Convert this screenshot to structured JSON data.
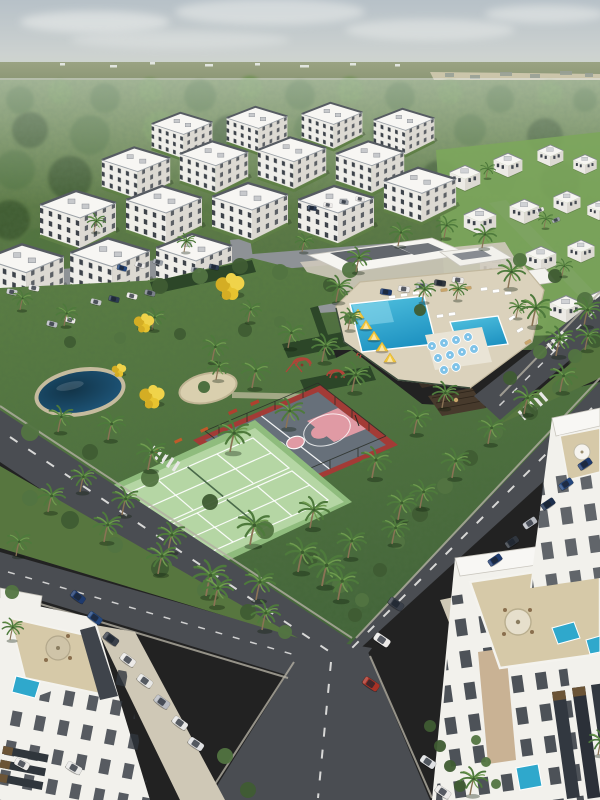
{
  "meta": {
    "alt_text": "Aerial rendering of a tropical residential community: white apartment blocks by a forest, central park with basketball and tennis courts, pond, playground, clubhouse with swimming pools, palm-lined roads and parked cars"
  },
  "palette": {
    "sky_top": "#b7c1c8",
    "sky_bottom": "#d7dad4",
    "forest_dark": "#3f5c33",
    "forest_mid": "#527441",
    "forest_light": "#6d9150",
    "park_green": "#5d8045",
    "road_asphalt": "#4a4d52",
    "pool_blue": "#2fa8cc",
    "court_pink": "#e09aa4",
    "court_red": "#a33b36",
    "tennis_green": "#b5d6a4",
    "cabana_yellow": "#f2c73c",
    "building_white": "#f2f1ec",
    "terrace_tan": "#d6c9a8",
    "pond_blue": "#1f5a80"
  },
  "scene": {
    "clouds": [
      [
        95,
        22,
        75,
        11,
        0.55
      ],
      [
        270,
        12,
        95,
        13,
        0.5
      ],
      [
        430,
        30,
        85,
        11,
        0.45
      ],
      [
        545,
        14,
        60,
        9,
        0.5
      ],
      [
        180,
        40,
        110,
        9,
        0.35
      ]
    ],
    "specks": [
      [
        60,
        63,
        5,
        0
      ],
      [
        110,
        65,
        7,
        0
      ],
      [
        150,
        62,
        5,
        0
      ],
      [
        205,
        64,
        8,
        0
      ],
      [
        255,
        63,
        5,
        0
      ],
      [
        300,
        65,
        9,
        0
      ],
      [
        350,
        63,
        6,
        0
      ],
      [
        395,
        64,
        5,
        0
      ],
      [
        445,
        73,
        9,
        1
      ],
      [
        470,
        75,
        10,
        1
      ],
      [
        500,
        72,
        12,
        1
      ],
      [
        530,
        74,
        10,
        1
      ],
      [
        560,
        71,
        12,
        1
      ],
      [
        585,
        73,
        8,
        1
      ]
    ],
    "forest_blobs": [
      [
        20,
        100,
        14,
        1
      ],
      [
        60,
        92,
        12,
        2
      ],
      [
        105,
        98,
        15,
        1
      ],
      [
        150,
        90,
        12,
        2
      ],
      [
        200,
        96,
        16,
        1
      ],
      [
        250,
        88,
        12,
        2
      ],
      [
        300,
        95,
        15,
        1
      ],
      [
        350,
        90,
        13,
        2
      ],
      [
        400,
        97,
        15,
        1
      ],
      [
        450,
        92,
        12,
        2
      ],
      [
        500,
        99,
        14,
        1
      ],
      [
        550,
        93,
        12,
        2
      ],
      [
        585,
        100,
        12,
        1
      ],
      [
        30,
        130,
        18,
        0
      ],
      [
        90,
        135,
        20,
        1
      ],
      [
        160,
        128,
        17,
        2
      ],
      [
        230,
        134,
        19,
        0
      ],
      [
        310,
        128,
        16,
        1
      ],
      [
        390,
        133,
        18,
        0
      ],
      [
        470,
        130,
        16,
        1
      ],
      [
        545,
        136,
        18,
        0
      ],
      [
        15,
        170,
        20,
        1
      ],
      [
        70,
        178,
        22,
        0
      ],
      [
        130,
        172,
        18,
        1
      ],
      [
        440,
        180,
        20,
        0
      ],
      [
        500,
        176,
        18,
        1
      ],
      [
        560,
        182,
        20,
        0
      ],
      [
        10,
        220,
        20,
        0
      ],
      [
        40,
        250,
        22,
        1
      ],
      [
        15,
        290,
        20,
        0
      ],
      [
        30,
        330,
        22,
        1
      ],
      [
        10,
        370,
        20,
        0
      ],
      [
        25,
        400,
        18,
        1
      ],
      [
        560,
        330,
        16,
        0
      ],
      [
        585,
        360,
        15,
        1
      ],
      [
        470,
        350,
        14,
        0
      ],
      [
        430,
        330,
        12,
        1
      ]
    ],
    "bushes": [
      [
        30,
        498,
        8,
        1
      ],
      [
        70,
        520,
        9,
        0
      ],
      [
        115,
        545,
        8,
        1
      ],
      [
        160,
        568,
        9,
        0
      ],
      [
        205,
        590,
        8,
        1
      ],
      [
        248,
        612,
        8,
        0
      ],
      [
        285,
        632,
        7,
        1
      ],
      [
        30,
        432,
        9,
        1
      ],
      [
        90,
        452,
        8,
        0
      ],
      [
        150,
        478,
        9,
        1
      ],
      [
        210,
        502,
        8,
        0
      ],
      [
        265,
        530,
        9,
        1
      ],
      [
        310,
        558,
        8,
        0
      ],
      [
        340,
        585,
        8,
        1
      ],
      [
        355,
        615,
        7,
        0
      ],
      [
        560,
        388,
        8,
        1
      ],
      [
        530,
        412,
        8,
        0
      ],
      [
        575,
        356,
        7,
        1
      ],
      [
        495,
        432,
        8,
        1
      ],
      [
        470,
        458,
        8,
        0
      ],
      [
        445,
        486,
        8,
        1
      ],
      [
        420,
        514,
        8,
        0
      ],
      [
        398,
        542,
        7,
        1
      ],
      [
        380,
        570,
        7,
        0
      ],
      [
        362,
        600,
        7,
        1
      ],
      [
        12,
        592,
        7,
        1
      ],
      [
        225,
        756,
        8,
        1
      ],
      [
        248,
        790,
        8,
        0
      ],
      [
        430,
        726,
        6,
        0
      ],
      [
        440,
        746,
        6,
        0
      ],
      [
        450,
        766,
        6,
        0
      ],
      [
        460,
        786,
        6,
        0
      ],
      [
        476,
        740,
        5,
        1
      ],
      [
        486,
        762,
        5,
        1
      ],
      [
        496,
        784,
        5,
        1
      ],
      [
        350,
        270,
        8,
        1
      ],
      [
        330,
        285,
        7,
        0
      ],
      [
        520,
        260,
        7,
        1
      ],
      [
        555,
        276,
        7,
        0
      ],
      [
        585,
        300,
        8,
        1
      ],
      [
        595,
        340,
        8,
        0
      ],
      [
        540,
        352,
        7,
        1
      ],
      [
        510,
        378,
        7,
        0
      ],
      [
        160,
        286,
        8,
        0
      ],
      [
        200,
        276,
        8,
        1
      ],
      [
        240,
        266,
        8,
        0
      ],
      [
        280,
        272,
        8,
        1
      ],
      [
        245,
        330,
        7,
        0
      ],
      [
        280,
        322,
        6,
        1
      ],
      [
        70,
        342,
        6,
        0
      ],
      [
        120,
        338,
        6,
        1
      ],
      [
        180,
        334,
        6,
        0
      ],
      [
        350,
        318,
        6,
        1
      ],
      [
        420,
        310,
        6,
        0
      ]
    ],
    "apt_blocks": [
      [
        150,
        108,
        0.8
      ],
      [
        225,
        102,
        0.8
      ],
      [
        300,
        98,
        0.8
      ],
      [
        372,
        104,
        0.8
      ],
      [
        100,
        142,
        0.9
      ],
      [
        178,
        136,
        0.9
      ],
      [
        256,
        132,
        0.9
      ],
      [
        334,
        136,
        0.9
      ],
      [
        38,
        185,
        1.0
      ],
      [
        124,
        180,
        1.0
      ],
      [
        210,
        177,
        1.0
      ],
      [
        296,
        180,
        1.0
      ],
      [
        382,
        162,
        0.95
      ],
      [
        -18,
        238,
        1.05
      ],
      [
        68,
        232,
        1.05
      ],
      [
        154,
        228,
        1.0
      ]
    ],
    "villas": [
      [
        448,
        162,
        0.85
      ],
      [
        492,
        150,
        0.8
      ],
      [
        536,
        142,
        0.72
      ],
      [
        572,
        152,
        0.65
      ],
      [
        462,
        204,
        0.9
      ],
      [
        508,
        196,
        0.82
      ],
      [
        552,
        188,
        0.75
      ],
      [
        586,
        198,
        0.65
      ],
      [
        478,
        250,
        0.95
      ],
      [
        524,
        243,
        0.85
      ],
      [
        566,
        237,
        0.75
      ],
      [
        500,
        298,
        1.0
      ],
      [
        548,
        292,
        0.9
      ],
      [
        588,
        286,
        0.8
      ]
    ],
    "palms": [
      [
        212,
        362,
        0.85
      ],
      [
        252,
        388,
        0.95
      ],
      [
        288,
        348,
        0.85
      ],
      [
        322,
        362,
        0.9
      ],
      [
        352,
        392,
        0.95
      ],
      [
        230,
        452,
        1.05
      ],
      [
        286,
        428,
        0.95
      ],
      [
        148,
        470,
        1.0
      ],
      [
        108,
        440,
        0.9
      ],
      [
        58,
        432,
        0.85
      ],
      [
        372,
        478,
        1.0
      ],
      [
        398,
        520,
        0.95
      ],
      [
        338,
        600,
        1.05
      ],
      [
        298,
        572,
        1.1
      ],
      [
        256,
        600,
        1.0
      ],
      [
        250,
        545,
        1.1
      ],
      [
        310,
        528,
        1.0
      ],
      [
        216,
        380,
        0.75
      ],
      [
        414,
        434,
        0.9
      ],
      [
        442,
        408,
        0.85
      ],
      [
        48,
        512,
        0.9
      ],
      [
        104,
        542,
        0.95
      ],
      [
        158,
        574,
        1.0
      ],
      [
        214,
        606,
        1.0
      ],
      [
        262,
        630,
        0.95
      ],
      [
        560,
        392,
        0.9
      ],
      [
        524,
        414,
        0.9
      ],
      [
        585,
        350,
        0.8
      ],
      [
        488,
        444,
        0.9
      ],
      [
        452,
        478,
        0.95
      ],
      [
        420,
        508,
        0.9
      ],
      [
        392,
        544,
        0.9
      ],
      [
        336,
        302,
        0.85
      ],
      [
        356,
        272,
        0.8
      ],
      [
        398,
        246,
        0.75
      ],
      [
        444,
        238,
        0.7
      ],
      [
        482,
        248,
        0.75
      ],
      [
        508,
        288,
        0.9
      ],
      [
        532,
        326,
        1.0
      ],
      [
        556,
        356,
        0.95
      ],
      [
        584,
        326,
        0.9
      ],
      [
        206,
        596,
        1.15
      ],
      [
        16,
        556,
        0.8
      ],
      [
        10,
        640,
        0.7
      ],
      [
        322,
        586,
        1.15
      ],
      [
        348,
        558,
        0.95
      ],
      [
        470,
        795,
        0.9
      ],
      [
        598,
        755,
        0.8
      ],
      [
        64,
        326,
        0.7
      ],
      [
        152,
        330,
        0.7
      ],
      [
        248,
        322,
        0.7
      ],
      [
        348,
        330,
        0.7
      ],
      [
        422,
        302,
        0.7
      ],
      [
        302,
        252,
        0.6
      ],
      [
        184,
        252,
        0.6
      ],
      [
        94,
        232,
        0.6
      ],
      [
        20,
        310,
        0.65
      ],
      [
        456,
        300,
        0.6
      ],
      [
        516,
        318,
        0.6
      ],
      [
        562,
        276,
        0.55
      ],
      [
        486,
        178,
        0.5
      ],
      [
        544,
        228,
        0.5
      ],
      [
        168,
        552,
        0.95
      ],
      [
        122,
        515,
        0.9
      ],
      [
        80,
        492,
        0.85
      ]
    ],
    "yellow_trees": [
      [
        230,
        288,
        1.2
      ],
      [
        144,
        324,
        0.85
      ],
      [
        152,
        398,
        1.05
      ],
      [
        119,
        371,
        0.6
      ]
    ],
    "cars": [
      [
        78,
        597,
        36,
        0.85,
        "#1e3a6e"
      ],
      [
        95,
        618,
        36,
        0.85,
        "#24477e"
      ],
      [
        111,
        639,
        36,
        0.9,
        "#3a404a"
      ],
      [
        128,
        660,
        36,
        0.9,
        "#eceae8"
      ],
      [
        145,
        681,
        36,
        0.9,
        "#e8e8e6"
      ],
      [
        162,
        702,
        36,
        0.9,
        "#b9bcc2"
      ],
      [
        180,
        723,
        36,
        0.9,
        "#e8e8e6"
      ],
      [
        196,
        744,
        34,
        0.9,
        "#dfe0e2"
      ],
      [
        74,
        768,
        30,
        0.9,
        "#e8e8e6"
      ],
      [
        22,
        764,
        28,
        0.85,
        "#eceae8"
      ],
      [
        396,
        604,
        34,
        0.9,
        "#3a404a"
      ],
      [
        382,
        640,
        34,
        0.95,
        "#eceae8"
      ],
      [
        371,
        684,
        34,
        0.95,
        "#a83226"
      ],
      [
        428,
        762,
        34,
        0.9,
        "#dfe0e2"
      ],
      [
        443,
        792,
        34,
        0.9,
        "#eceae8"
      ],
      [
        585,
        464,
        -34,
        0.8,
        "#1e3a6e"
      ],
      [
        566,
        484,
        -34,
        0.8,
        "#24477e"
      ],
      [
        548,
        504,
        -34,
        0.8,
        "#1c2f4e"
      ],
      [
        530,
        523,
        -34,
        0.8,
        "#b9bcc2"
      ],
      [
        512,
        542,
        -34,
        0.8,
        "#30363e"
      ],
      [
        495,
        560,
        -34,
        0.8,
        "#1e3a6e"
      ],
      [
        96,
        302,
        14,
        0.6,
        "#c8cacd"
      ],
      [
        114,
        299,
        14,
        0.6,
        "#2c3b52"
      ],
      [
        132,
        296,
        14,
        0.6,
        "#eceae8"
      ],
      [
        150,
        293,
        14,
        0.6,
        "#7a8089"
      ],
      [
        122,
        268,
        16,
        0.55,
        "#24477e"
      ],
      [
        140,
        265,
        16,
        0.55,
        "#eceae8"
      ],
      [
        158,
        262,
        16,
        0.55,
        "#9aa0a8"
      ],
      [
        312,
        208,
        10,
        0.5,
        "#2c3b52"
      ],
      [
        328,
        205,
        10,
        0.5,
        "#eceae8"
      ],
      [
        344,
        202,
        10,
        0.5,
        "#9aa0a8"
      ],
      [
        360,
        199,
        10,
        0.5,
        "#eceae8"
      ],
      [
        386,
        292,
        8,
        0.65,
        "#1e3a6e"
      ],
      [
        404,
        289,
        8,
        0.65,
        "#eceae8"
      ],
      [
        422,
        286,
        8,
        0.65,
        "#b9bcc2"
      ],
      [
        440,
        283,
        8,
        0.65,
        "#30363e"
      ],
      [
        458,
        280,
        8,
        0.65,
        "#eceae8"
      ],
      [
        12,
        292,
        12,
        0.6,
        "#c8cacd"
      ],
      [
        34,
        288,
        12,
        0.6,
        "#eceae8"
      ],
      [
        52,
        324,
        14,
        0.6,
        "#b9bcc2"
      ],
      [
        70,
        320,
        14,
        0.6,
        "#eceae8"
      ],
      [
        196,
        270,
        12,
        0.55,
        "#9aa0a8"
      ],
      [
        214,
        267,
        12,
        0.55,
        "#2c3b52"
      ],
      [
        540,
        210,
        -20,
        0.45,
        "#eceae8"
      ],
      [
        556,
        220,
        -20,
        0.45,
        "#9aa0a8"
      ]
    ],
    "loungers": [
      [
        392,
        297,
        -7,
        "#ffffff"
      ],
      [
        404,
        295,
        -7,
        "#ffffff"
      ],
      [
        416,
        293,
        -7,
        "#ffffff"
      ],
      [
        428,
        292,
        -7,
        "#ffffff"
      ],
      [
        444,
        290,
        -7,
        "#c9a56a"
      ],
      [
        456,
        289,
        -7,
        "#c9a56a"
      ],
      [
        468,
        288,
        -7,
        "#c9a56a"
      ],
      [
        484,
        289,
        -7,
        "#ffffff"
      ],
      [
        496,
        291,
        -7,
        "#ffffff"
      ],
      [
        508,
        293,
        -7,
        "#ffffff"
      ],
      [
        512,
        318,
        -30,
        "#ffffff"
      ],
      [
        520,
        330,
        -30,
        "#ffffff"
      ],
      [
        528,
        342,
        -30,
        "#c9a56a"
      ],
      [
        440,
        316,
        -8,
        "#ffffff"
      ],
      [
        452,
        314,
        -8,
        "#ffffff"
      ]
    ],
    "parasols": [
      [
        432,
        346
      ],
      [
        444,
        343
      ],
      [
        456,
        340
      ],
      [
        468,
        337
      ],
      [
        438,
        358
      ],
      [
        450,
        355
      ],
      [
        462,
        352
      ],
      [
        474,
        349
      ],
      [
        444,
        370
      ],
      [
        456,
        367
      ]
    ],
    "cabanas": [
      [
        358,
        316,
        1
      ],
      [
        366,
        327,
        1
      ],
      [
        374,
        338,
        1
      ],
      [
        382,
        349,
        1
      ],
      [
        390,
        360,
        1
      ]
    ]
  }
}
